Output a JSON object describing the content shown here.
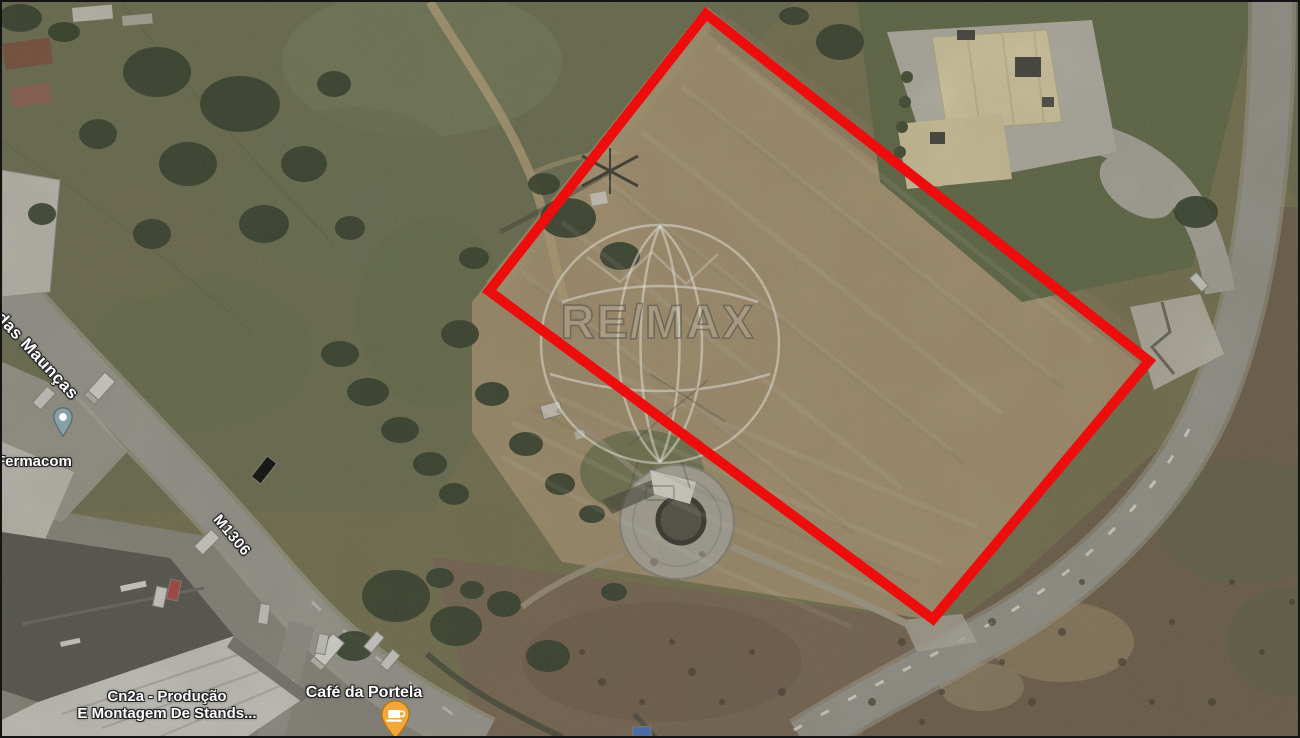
{
  "map": {
    "watermark": {
      "text": "RE/MAX"
    },
    "boundary": {
      "points": "704,12 1147,359 931,617 487,289",
      "color": "#ee0d0d",
      "stroke_width": "10"
    },
    "roads": [
      {
        "label": "das Maunças"
      },
      {
        "label": "M1306"
      }
    ],
    "places": [
      {
        "label": "Fermacom",
        "pin": "place-pin",
        "pin_color": "#87a0a6"
      },
      {
        "label": "Cn2a - Produção E Montagem De Stands...",
        "line1": "Cn2a - Produção",
        "line2": "E Montagem De Stands..."
      },
      {
        "label": "Café da Portela",
        "pin": "cafe-pin",
        "pin_color": "#f2a838",
        "pin_glyph": "coffee-cup"
      }
    ],
    "terrain_colors": {
      "field_green": "#6d7150",
      "plot_tan": "#ab9671",
      "scrub_brown": "#7c6853",
      "road_gray": "#a3a29a",
      "pavement_gray": "#8e8c83",
      "tree_green": "#2e3b26",
      "roof_cream": "#e8dcb2",
      "roof_dark": "#55544f",
      "roof_white": "#d9d8d2"
    }
  }
}
